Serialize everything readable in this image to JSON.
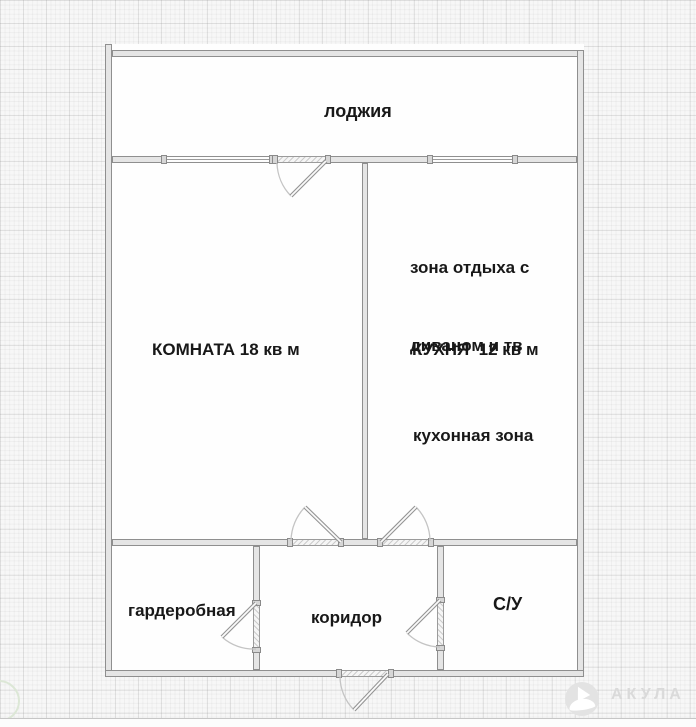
{
  "meta": {
    "type": "apartment-floor-plan"
  },
  "rooms": {
    "loggia": {
      "label": "лоджия"
    },
    "living": {
      "label": "КОМНАТА 18 кв м"
    },
    "kitchen": {
      "label": "КУХНЯ  12 кв м",
      "lounge_line1": "зона отдыха с",
      "lounge_line2": "диваном и тв",
      "cooking": "кухонная зона"
    },
    "wardrobe": {
      "label": "гардеробная"
    },
    "corridor": {
      "label": "коридор"
    },
    "bathroom": {
      "label": "С/У"
    }
  },
  "watermark": {
    "brand": "АКУЛА"
  },
  "colors": {
    "background": "#f7f7f7",
    "wall_fill": "#e5e5e5",
    "wall_border": "#8f8f8f",
    "label_text": "#181818",
    "watermark_text": "#dadada"
  }
}
